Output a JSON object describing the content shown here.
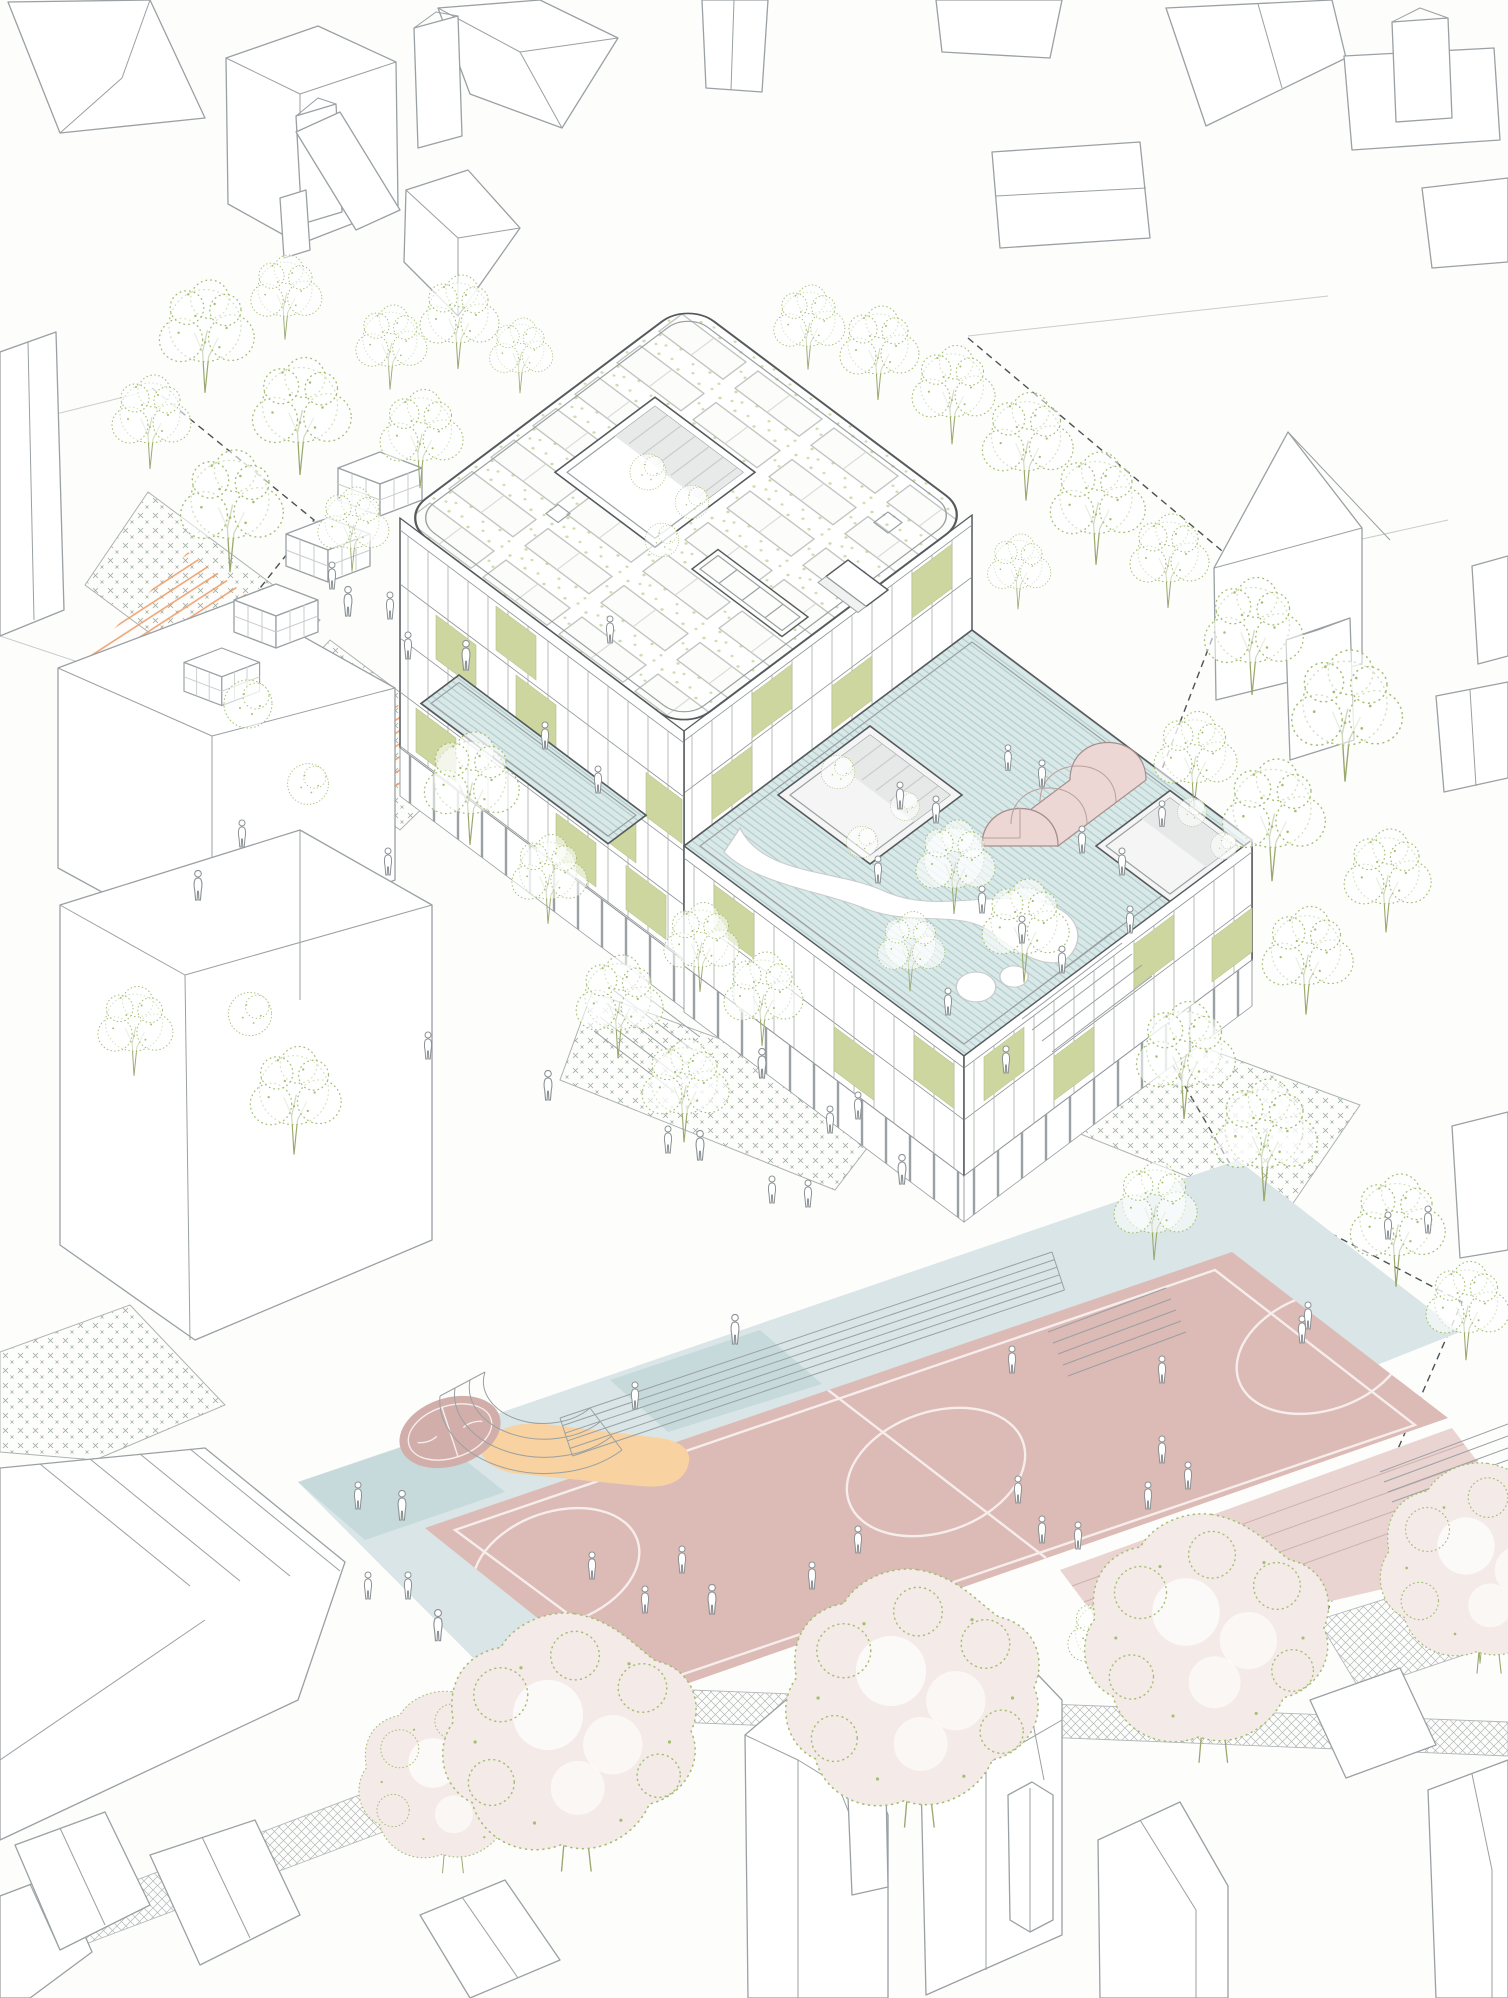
{
  "illustration": {
    "kind": "architectural-axonometric-site-illustration",
    "subject": "new school building with photovoltaic roof and rooftop play terrace, surrounded by plazas, sports courts, trees and existing neighbourhood houses",
    "visible_text": "",
    "counts": {
      "context_buildings": 29,
      "trees": 41,
      "shrubs": 3,
      "courtyard_planting_clusters": 8,
      "blossom_trees": 5,
      "garden_sheds": 4,
      "pedestrians": 60,
      "roof_courtyard_openings": 3,
      "rooftop_greenhouses": 1,
      "sports_courts": 2
    },
    "features": [
      "solar-panel-roof-with-green-dot-gravel",
      "roof-courtyard-cutout",
      "blue-hatched-roof-terrace-with-white-play-path",
      "pink-barrel-vault-greenhouse",
      "sage-green-facade-awnings",
      "pilotis-ground-floor",
      "orange-hatched-ramps",
      "cross-hatched-planting-beds",
      "amphitheater-steps",
      "basketball-court-with-white-markings",
      "mini-round-court",
      "peach-play-blobs",
      "blossom-trees-row",
      "dashed-site-boundary",
      "white-context-houses"
    ]
  },
  "palette": {
    "paper": "#fdfdfc",
    "line": "#9aa0a3",
    "line_dark": "#55595c",
    "line_soft": "#c9cccd",
    "green": "#a4bf72",
    "green_soft": "#cddcab",
    "awning": "#ccd69e",
    "terrace_blue": "#dbe8e8",
    "terrace_hatch": "#a8cccc",
    "apron_blue": "#d9e5e6",
    "apron_blue_dark": "#c7dadb",
    "court_pink": "#dcbab5",
    "court_pink_dark": "#d2aeaa",
    "court_line": "#f6eeec",
    "steps_pink": "#e9d4d1",
    "blossom": "#f4eae7",
    "peach": "#f8d2a0",
    "orange_hatch": "#eda06c",
    "greenhouse_pink": "#ecd7d4",
    "people": "#8b9194",
    "boundary": "#4c5154"
  }
}
